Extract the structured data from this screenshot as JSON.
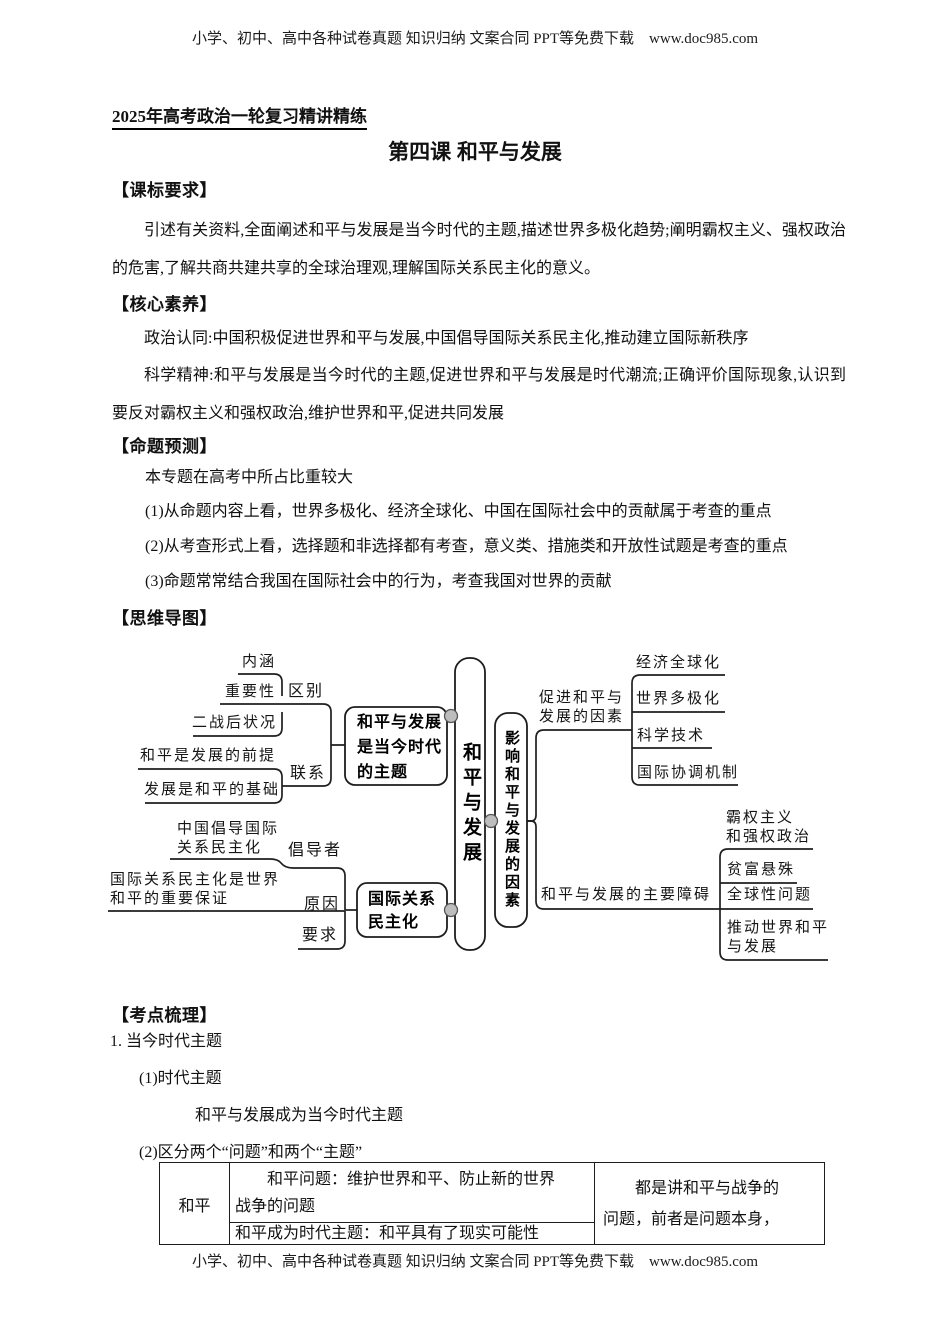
{
  "header": {
    "text": "小学、初中、高中各种试卷真题 知识归纳 文案合同 PPT等免费下载　www.doc985.com"
  },
  "footer": {
    "text": "小学、初中、高中各种试卷真题 知识归纳 文案合同 PPT等免费下载　www.doc985.com"
  },
  "titles": {
    "series": "2025年高考政治一轮复习精讲精练",
    "lesson": "第四课 和平与发展"
  },
  "sections": {
    "biaoyao": {
      "heading": "【课标要求】",
      "body": "引述有关资料,全面阐述和平与发展是当今时代的主题,描述世界多极化趋势;阐明霸权主义、强权政治的危害,了解共商共建共享的全球治理观,理解国际关系民主化的意义。"
    },
    "suyang": {
      "heading": "【核心素养】",
      "p1": "政治认同:中国积极促进世界和平与发展,中国倡导国际关系民主化,推动建立国际新秩序",
      "p2": "科学精神:和平与发展是当今时代的主题,促进世界和平与发展是时代潮流;正确评价国际现象,认识到要反对霸权主义和强权政治,维护世界和平,促进共同发展"
    },
    "yuce": {
      "heading": "【命题预测】",
      "line1": "本专题在高考中所占比重较大",
      "line2": "(1)从命题内容上看，世界多极化、经济全球化、中国在国际社会中的贡献属于考查的重点",
      "line3": "(2)从考查形式上看，选择题和非选择都有考查，意义类、措施类和开放性试题是考查的重点",
      "line4": "(3)命题常常结合我国在国际社会中的行为，考查我国对世界的贡献"
    },
    "daotu": {
      "heading": "【思维导图】"
    },
    "shuli": {
      "heading": "【考点梳理】",
      "line1": "1. 当今时代主题",
      "line2": "(1)时代主题",
      "line3": "和平与发展成为当今时代主题",
      "line4": "(2)区分两个“问题”和两个“主题”"
    }
  },
  "mindmap": {
    "center": "和平与发展",
    "theme_box": "和平与发展\n是当今时代\n的主题",
    "neihan": "内涵",
    "zhongyaoxing": "重要性",
    "qubie": "区别",
    "erzhan": "二战后状况",
    "qianti": "和平是发展的前提",
    "lianxi": "联系",
    "jichu": "发展是和平的基础",
    "changdao": "中国倡导国际\n关系民主化",
    "changdaozhe": "倡导者",
    "baozheng": "国际关系民主化是世界\n和平的重要保证",
    "yuanyin": "原因",
    "yaoqiu": "要求",
    "intl_box": "国际关系\n民主化",
    "factors_box": "影响和平与发展的因素",
    "promote": "促进和平与\n发展的因素",
    "jingji": "经济全球化",
    "duoji": "世界多极化",
    "keji": "科学技术",
    "xietiao": "国际协调机制",
    "zhangai": "和平与发展的主要障碍",
    "baquan": "霸权主义\n和强权政治",
    "pinfu": "贫富悬殊",
    "quanqiu": "全球性问题",
    "tuidong": "推动世界和平\n与发展"
  },
  "table": {
    "c1": "和平",
    "r1c2": "和平问题：维护世界和平、防止新的世界\n战争的问题",
    "r2c2": "和平成为时代主题：和平具有了现实可能性",
    "c3": "都是讲和平与战争的\n问题，前者是问题本身，"
  }
}
